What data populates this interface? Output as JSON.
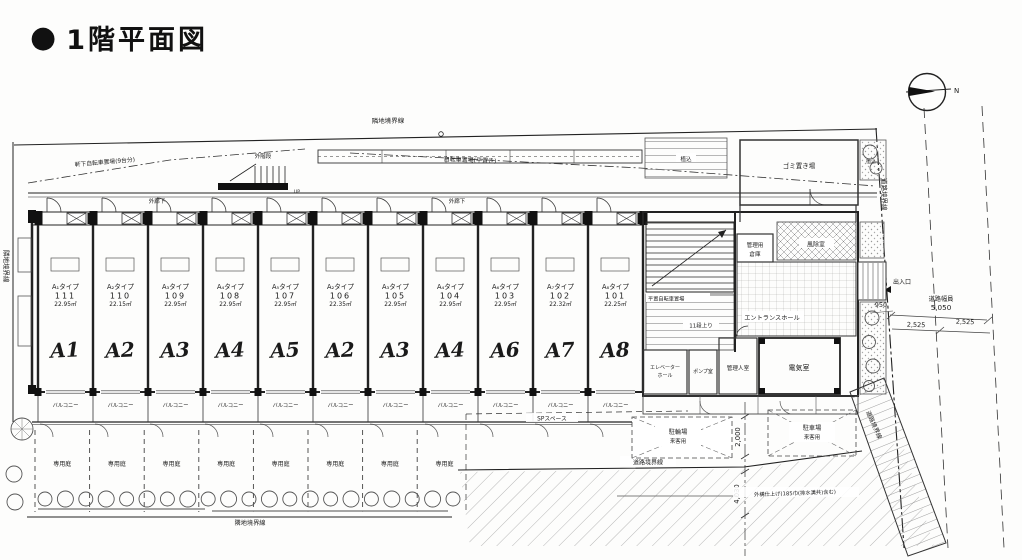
{
  "title": {
    "bullet_icon": "●",
    "text": "1階平面図"
  },
  "compass": {
    "north": "N"
  },
  "boundary_labels": {
    "top": "隣地境界線",
    "left": "隣地境界線",
    "bottom": "隣地境界線",
    "road_right": "道路境界線",
    "road_bottom": "道路境界線",
    "road_diagonal": "道路境界線"
  },
  "site_annotations": {
    "bike_eaves": "軒下自転車置場(9台分)",
    "bike_flat": "自転車置場(平置き)",
    "outdoor_stair": "外階段",
    "up": "UP",
    "corridor": "外廊下",
    "planting_1": "植込",
    "planting_2": "植込",
    "trash_room": "ゴミ置き場",
    "mgmt_storage_l1": "管理用",
    "mgmt_storage_l2": "倉庫",
    "windbreak": "風除室",
    "entrance_hall": "エントランスホール",
    "bike_flat_inner": "平置自転車置場",
    "steps_note": "11段上り",
    "elevator_l1": "エレベーター",
    "elevator_l2": "ホール",
    "pump_room": "ポンプ室",
    "manager_room": "管理人室",
    "electrical_room": "電気室",
    "entry": "出入口",
    "sp_space": "SPスペース",
    "visitor_bike_l1": "駐輪場",
    "visitor_bike_l2": "来客用",
    "visitor_car_l1": "駐車場",
    "visitor_car_l2": "来客用",
    "pavement_note": "外構仕上げ(185巾(排水溝共)含む)"
  },
  "dimensions": {
    "entry_width": "950",
    "road_width_caption": "道路幅員",
    "road_width": "5,050",
    "road_half_1": "2,525",
    "road_half_2": "2,525",
    "dim_2000": "2,000",
    "dim_4030": "4,030"
  },
  "labels": {
    "balcony": "バルコニー",
    "garden": "専用庭"
  },
  "units": [
    {
      "type": "A₁タイプ",
      "number": "111",
      "area": "22.95㎡",
      "mark": "A1"
    },
    {
      "type": "A₂タイプ",
      "number": "110",
      "area": "22.15㎡",
      "mark": "A2"
    },
    {
      "type": "A₃タイプ",
      "number": "109",
      "area": "22.95㎡",
      "mark": "A3"
    },
    {
      "type": "A₄タイプ",
      "number": "108",
      "area": "22.95㎡",
      "mark": "A4"
    },
    {
      "type": "A₅タイプ",
      "number": "107",
      "area": "22.95㎡",
      "mark": "A5"
    },
    {
      "type": "A₂タイプ",
      "number": "106",
      "area": "22.35㎡",
      "mark": "A2"
    },
    {
      "type": "A₃タイプ",
      "number": "105",
      "area": "22.95㎡",
      "mark": "A3"
    },
    {
      "type": "A₄タイプ",
      "number": "104",
      "area": "22.95㎡",
      "mark": "A4"
    },
    {
      "type": "A₆タイプ",
      "number": "103",
      "area": "22.95㎡",
      "mark": "A6"
    },
    {
      "type": "A₇タイプ",
      "number": "102",
      "area": "22.32㎡",
      "mark": "A7"
    },
    {
      "type": "A₈タイプ",
      "number": "101",
      "area": "22.25㎡",
      "mark": "A8"
    }
  ],
  "gardens": [
    "専用庭",
    "専用庭",
    "専用庭",
    "専用庭",
    "専用庭",
    "専用庭",
    "専用庭",
    "専用庭"
  ]
}
